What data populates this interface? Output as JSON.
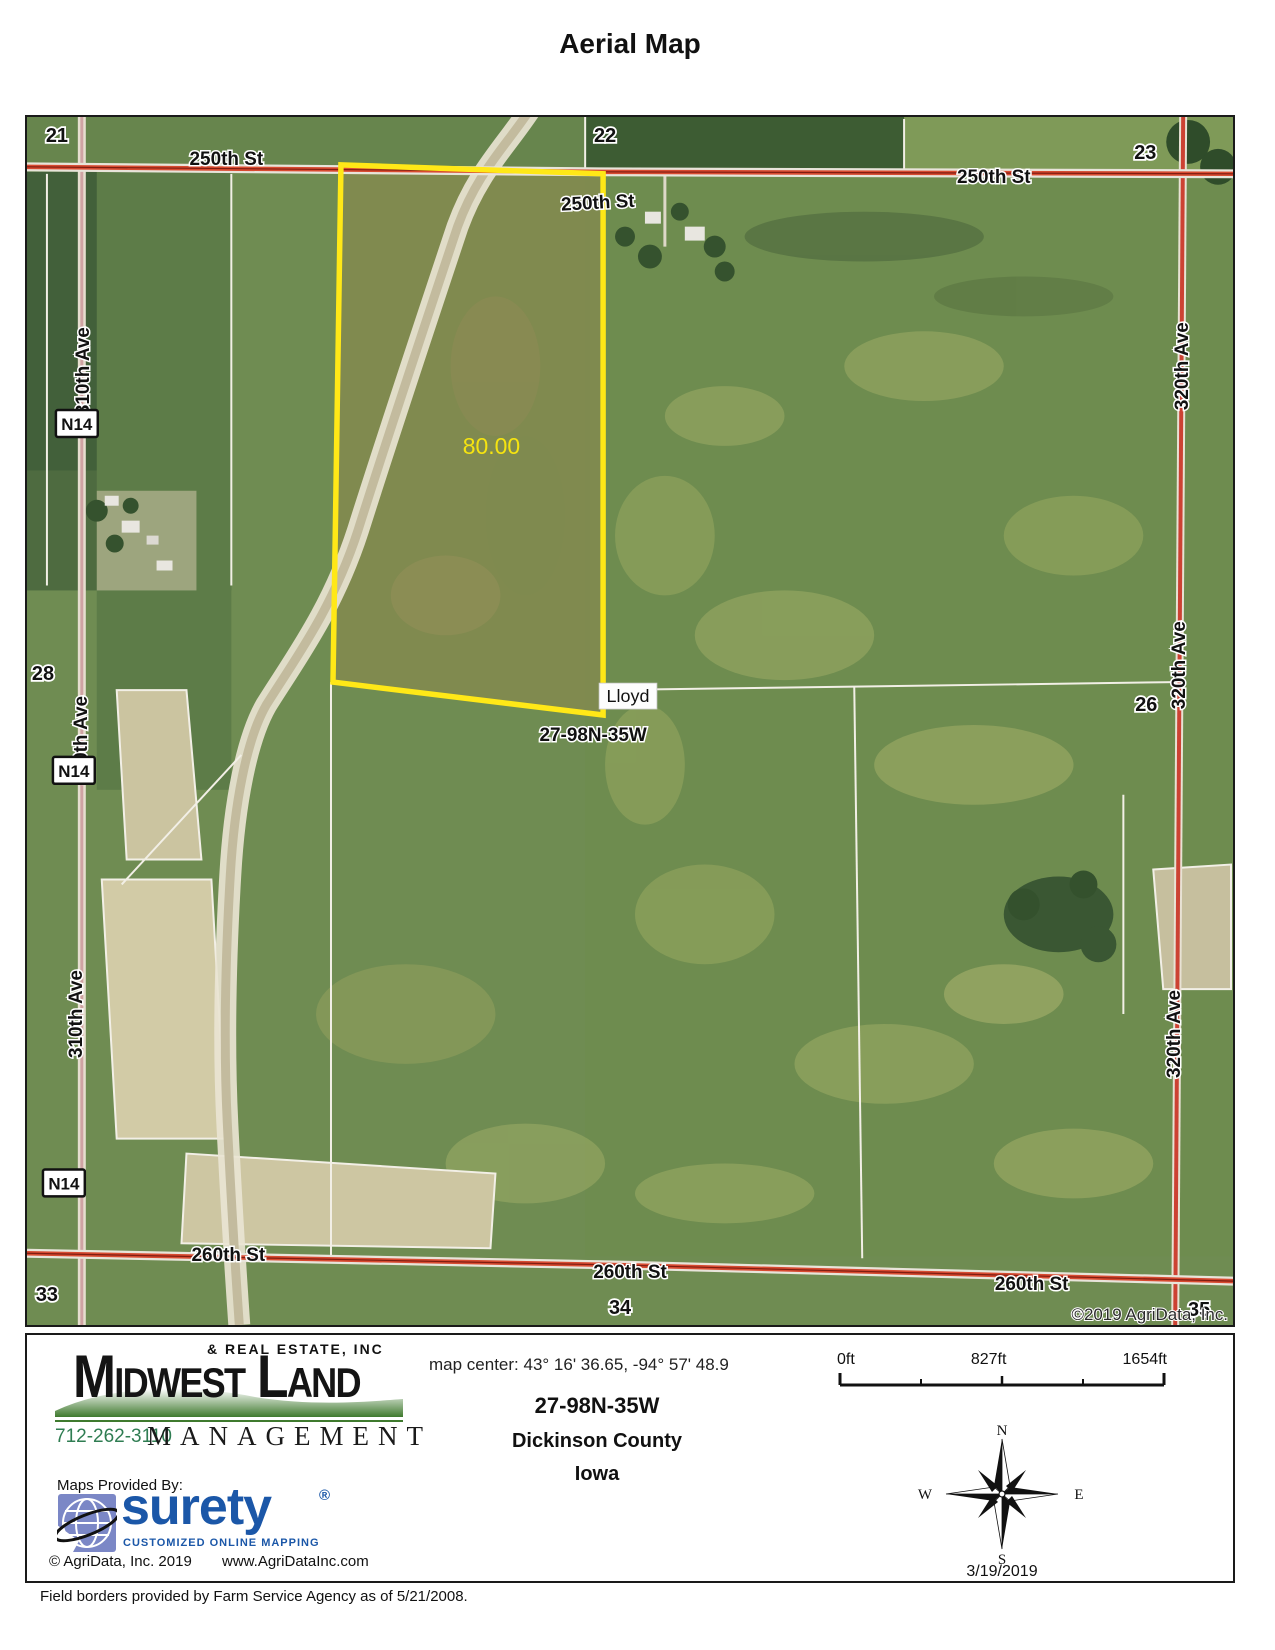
{
  "title": "Aerial Map",
  "map": {
    "road_250": "250th St",
    "road_260": "260th St",
    "ave_310": "310th Ave",
    "ave_320": "320th Ave",
    "hwy_n14": "N14",
    "sec_21": "21",
    "sec_22": "22",
    "sec_23": "23",
    "sec_26": "26",
    "sec_28": "28",
    "sec_33": "33",
    "sec_34": "34",
    "sec_35": "35",
    "acres": "80.00",
    "owner": "Lloyd",
    "township_line": "27-98N-35W",
    "copyright": "©2019 AgriData, Inc.",
    "parcel_color": "#ffe817",
    "road_color": "#cc4233"
  },
  "footer": {
    "logo": {
      "tagline_top": "& REAL ESTATE, INC",
      "name": "Midwest Land",
      "phone": "712-262-3110",
      "management": "MANAGEMENT"
    },
    "map_center": "map center: 43° 16' 36.65,  -94° 57' 48.9",
    "scale": {
      "zero": "0ft",
      "mid": "827ft",
      "max": "1654ft"
    },
    "location": {
      "township": "27-98N-35W",
      "county": "Dickinson County",
      "state": "Iowa"
    },
    "compass": {
      "n": "N",
      "s": "S",
      "e": "E",
      "w": "W"
    },
    "date": "3/19/2019",
    "surety": {
      "provided_by": "Maps Provided By:",
      "brand": "surety",
      "reg": "®",
      "tagline": "CUSTOMIZED ONLINE MAPPING",
      "copyright": "© AgriData, Inc. 2019",
      "website": "www.AgriDataInc.com",
      "brand_color": "#1b57a8"
    }
  },
  "note": "Field borders provided by Farm Service Agency as of 5/21/2008."
}
